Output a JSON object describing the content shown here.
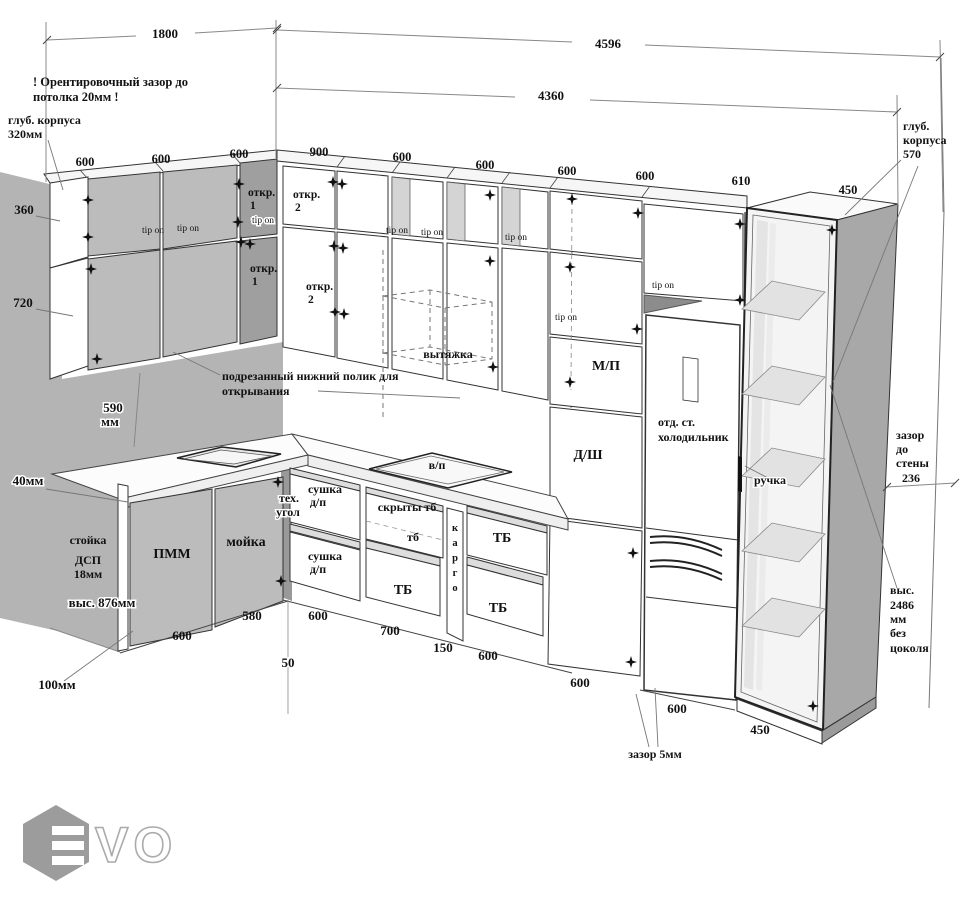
{
  "colors": {
    "wall": "#b4b4b4",
    "door": "#bdbdbd",
    "corner_door": "#9f9f9f",
    "niche": "#d4d4d4",
    "side_panel": "#a8a8a8",
    "ink": "#222222",
    "logo": "#9c9c9c"
  },
  "top_dims": {
    "total_left": "1800",
    "total_right": "4596",
    "run_right": "4360"
  },
  "width_labels": [
    "600",
    "600",
    "600",
    "900",
    "600",
    "600",
    "600",
    "600",
    "610",
    "450"
  ],
  "height_labels": {
    "h360": "360",
    "h720": "720",
    "h590_1": "590",
    "h590_2": "мм",
    "off40": "40мм",
    "h876": "выс. 876мм",
    "h100": "100мм"
  },
  "warning_lines": [
    "! Орентировочный зазор до",
    "потолка 20мм !"
  ],
  "depth_left": [
    "глуб. корпуса",
    "320мм"
  ],
  "depth_right": [
    "глуб.",
    "корпуса",
    "570"
  ],
  "trim_note": [
    "подрезанный нижний полик для",
    "открывания"
  ],
  "wall_gap": [
    "зазор",
    "до",
    "стены",
    "236"
  ],
  "height_note": [
    "выс.",
    "2486",
    "мм",
    "без",
    "цоколя"
  ],
  "gap5": "зазор 5мм",
  "labels": {
    "tip_on": "tip on",
    "otkr": "откр.",
    "n1": "1",
    "n2": "2",
    "hood": "вытяжка",
    "microwave": "М/П",
    "dsh": "Д/Ш",
    "fridge_1": "отд. ст.",
    "fridge_2": "холодильник",
    "handle": "ручка",
    "hob": "в/п",
    "dishwasher": "ПММ",
    "sink": "мойка",
    "tech_1": "тех.",
    "tech_2": "угол",
    "stand_1": "стойка",
    "stand_2": "ДСП",
    "stand_3": "18мм",
    "dry_1": "сушка",
    "dry_2": "д/п",
    "hidden_tb": "скрыты тб",
    "tb_sm": "тб",
    "tb": "ТБ",
    "cargo": [
      "к",
      "а",
      "р",
      "г",
      "о"
    ]
  },
  "bottom_dims": [
    "600",
    "580",
    "50",
    "600",
    "700",
    "150",
    "600",
    "600",
    "600",
    "450"
  ],
  "logo_text": "VO"
}
